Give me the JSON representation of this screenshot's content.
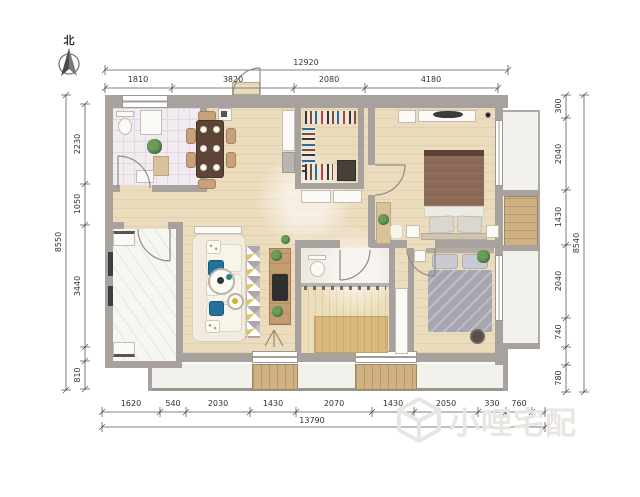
{
  "north": {
    "label": "北"
  },
  "dimensions": {
    "top": {
      "overall": "12920",
      "segments": [
        "1810",
        "3820",
        "2080",
        "4180"
      ]
    },
    "bottom": {
      "overall": "13790",
      "segments": [
        "1620",
        "540",
        "2030",
        "1430",
        "2070",
        "1430",
        "2050",
        "330",
        "760"
      ]
    },
    "left": {
      "overall": "8550",
      "segments": [
        "2230",
        "1050",
        "3440",
        "810"
      ]
    },
    "right": {
      "overall": "8540",
      "segments": [
        "300",
        "2040",
        "1430",
        "2040",
        "740",
        "780"
      ]
    }
  },
  "watermark": {
    "text": "小哩宅配"
  },
  "colors": {
    "wall_gray": "#a7a29e",
    "wood_floor": "#ebdcbe",
    "deck_wood": "#cfb183",
    "bathroom_tile": "#f2ecf1",
    "accent_blue": "#24719b",
    "accent_yellow": "#e0c45e",
    "bed_brown": "#8a6a56",
    "bed_gray": "#a6a6b0"
  }
}
